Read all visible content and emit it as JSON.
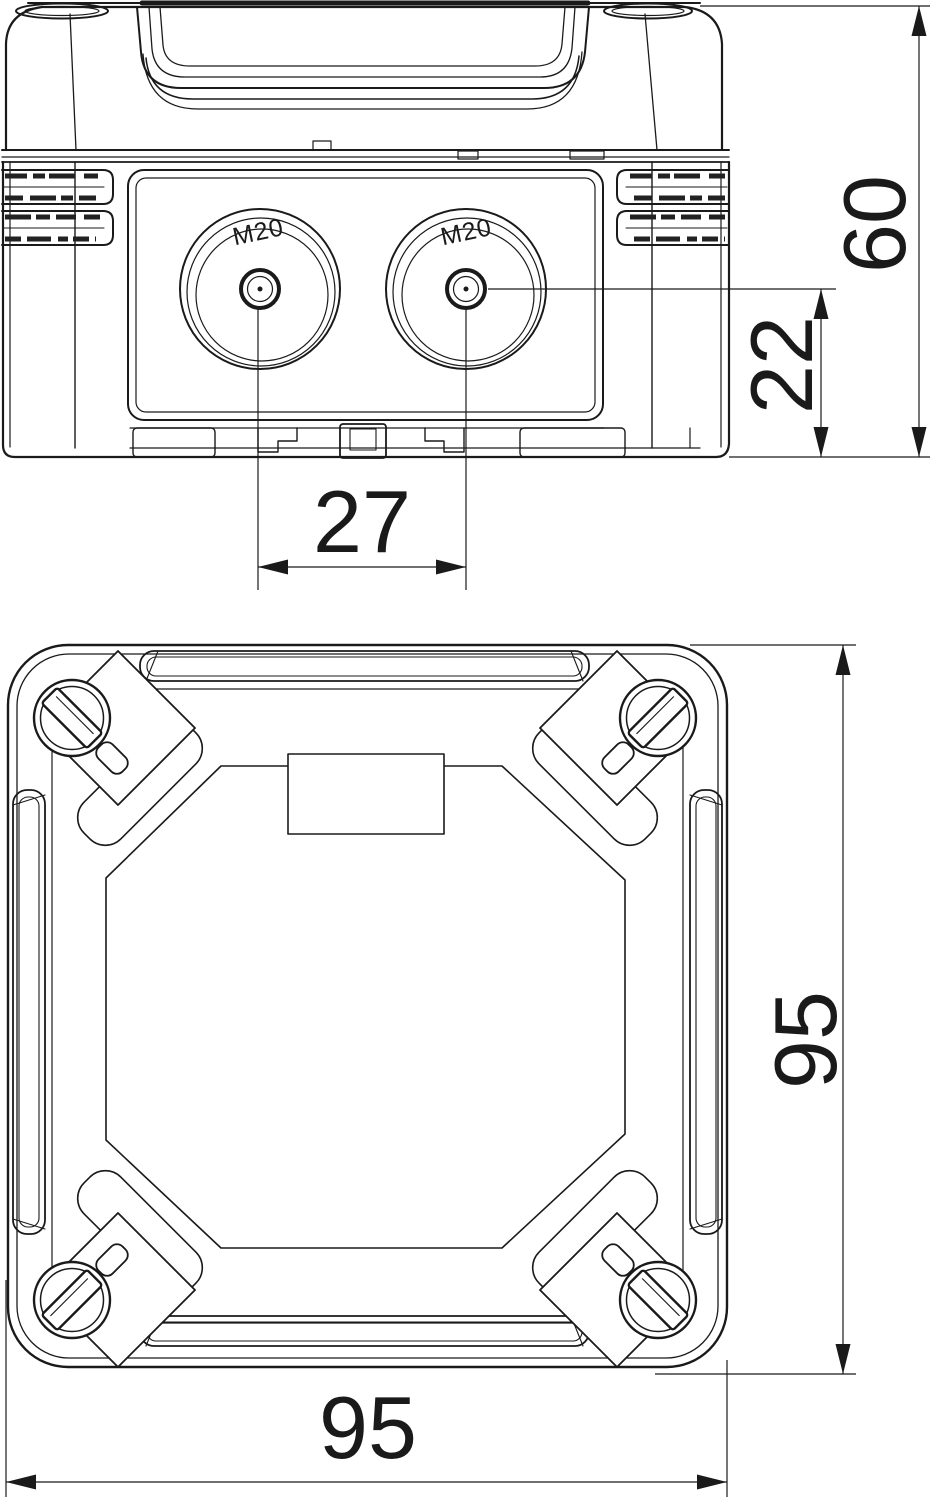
{
  "drawing": {
    "background": "#ffffff",
    "line_color": "#1a1a1a",
    "front_view": {
      "name": "front elevation with cable entries",
      "entry_left_label": "M20",
      "entry_right_label": "M20",
      "dim_total_height": "60",
      "dim_entry_center_height": "22",
      "dim_entry_spacing": "27"
    },
    "plan_view": {
      "name": "plan view with lid screws",
      "dim_depth": "95",
      "dim_width": "95"
    }
  }
}
